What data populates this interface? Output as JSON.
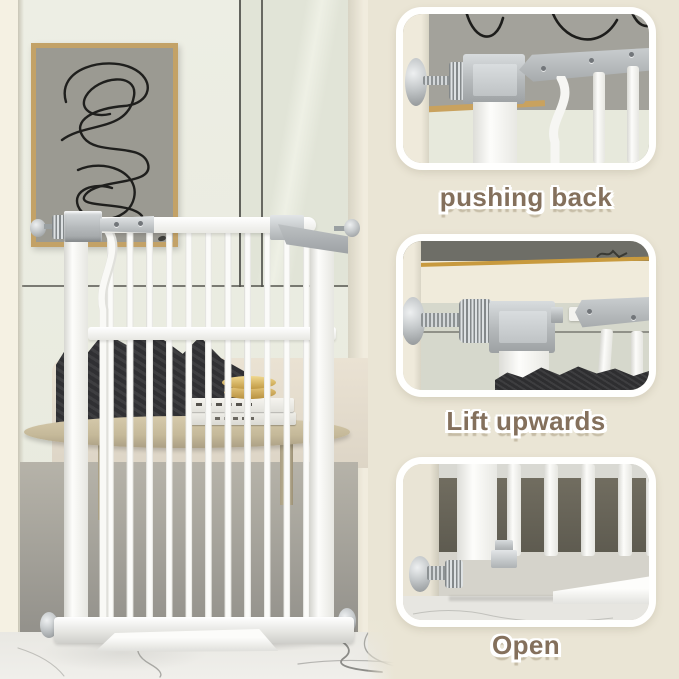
{
  "steps": [
    {
      "id": "pushing-back",
      "label": "pushing back"
    },
    {
      "id": "lift-upwards",
      "label": "Lift upwards"
    },
    {
      "id": "open",
      "label": "Open"
    }
  ],
  "colors": {
    "background_cream": "#ebe6d7",
    "caption_text": "#84705c",
    "caption_outline": "#ffffff",
    "gate_white": "#f9f9f7",
    "hardware_silver": "#b7bbbd",
    "wall_art_gray": "#9a9992",
    "frame_tan": "#c3a267",
    "gold_frame_edge": "#c89a3e",
    "blanket_dark": "#313134",
    "marble_vein": "#8c8c88"
  }
}
